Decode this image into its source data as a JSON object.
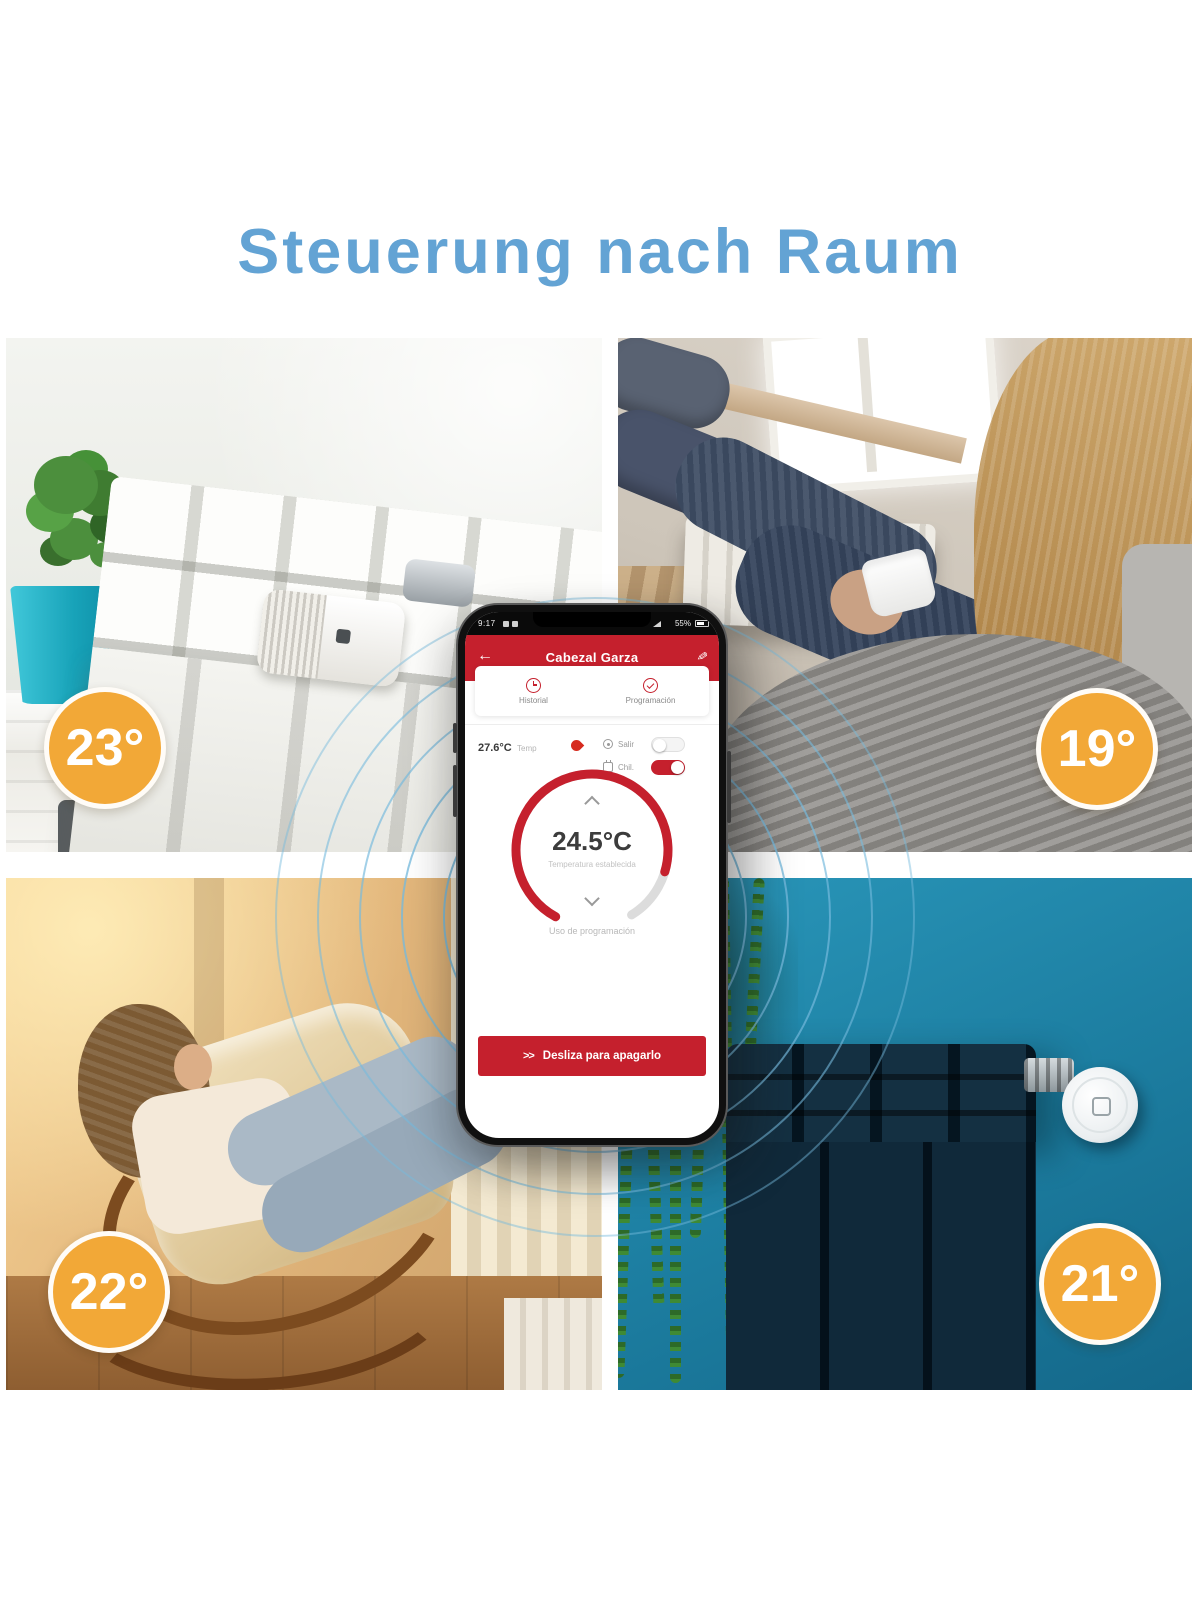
{
  "page": {
    "title": "Steuerung nach Raum"
  },
  "badges": {
    "top_left": "23°",
    "top_right": "19°",
    "bottom_left": "22°",
    "bottom_right": "21°"
  },
  "phone": {
    "status_bar": {
      "time": "9:17",
      "battery_percent": "55%"
    },
    "header": {
      "back_icon": "←",
      "title": "Cabezal Garza",
      "edit_icon": "✎"
    },
    "tabs": [
      {
        "label": "Historial",
        "icon": "clock-icon"
      },
      {
        "label": "Programación",
        "icon": "check-circle-icon"
      }
    ],
    "temperature_row": {
      "current_temp": "27.6°C",
      "temp_label": "Temp"
    },
    "modes": [
      {
        "label": "Salir",
        "state": "off"
      },
      {
        "label": "Chil.",
        "state": "on"
      }
    ],
    "dial": {
      "set_temp": "24.5°C",
      "set_temp_label": "Temperatura establecida",
      "program_label": "Uso de programación"
    },
    "slide_button": {
      "arrows": ">>",
      "label": "Desliza para apagarlo"
    }
  },
  "colors": {
    "accent_red": "#c5202d",
    "title_blue": "#63a3d4",
    "badge_orange": "#f2a837",
    "teal_wall": "#1d7fa2",
    "pot_teal": "#18a3b9",
    "ripple_blue": "#76badd"
  }
}
